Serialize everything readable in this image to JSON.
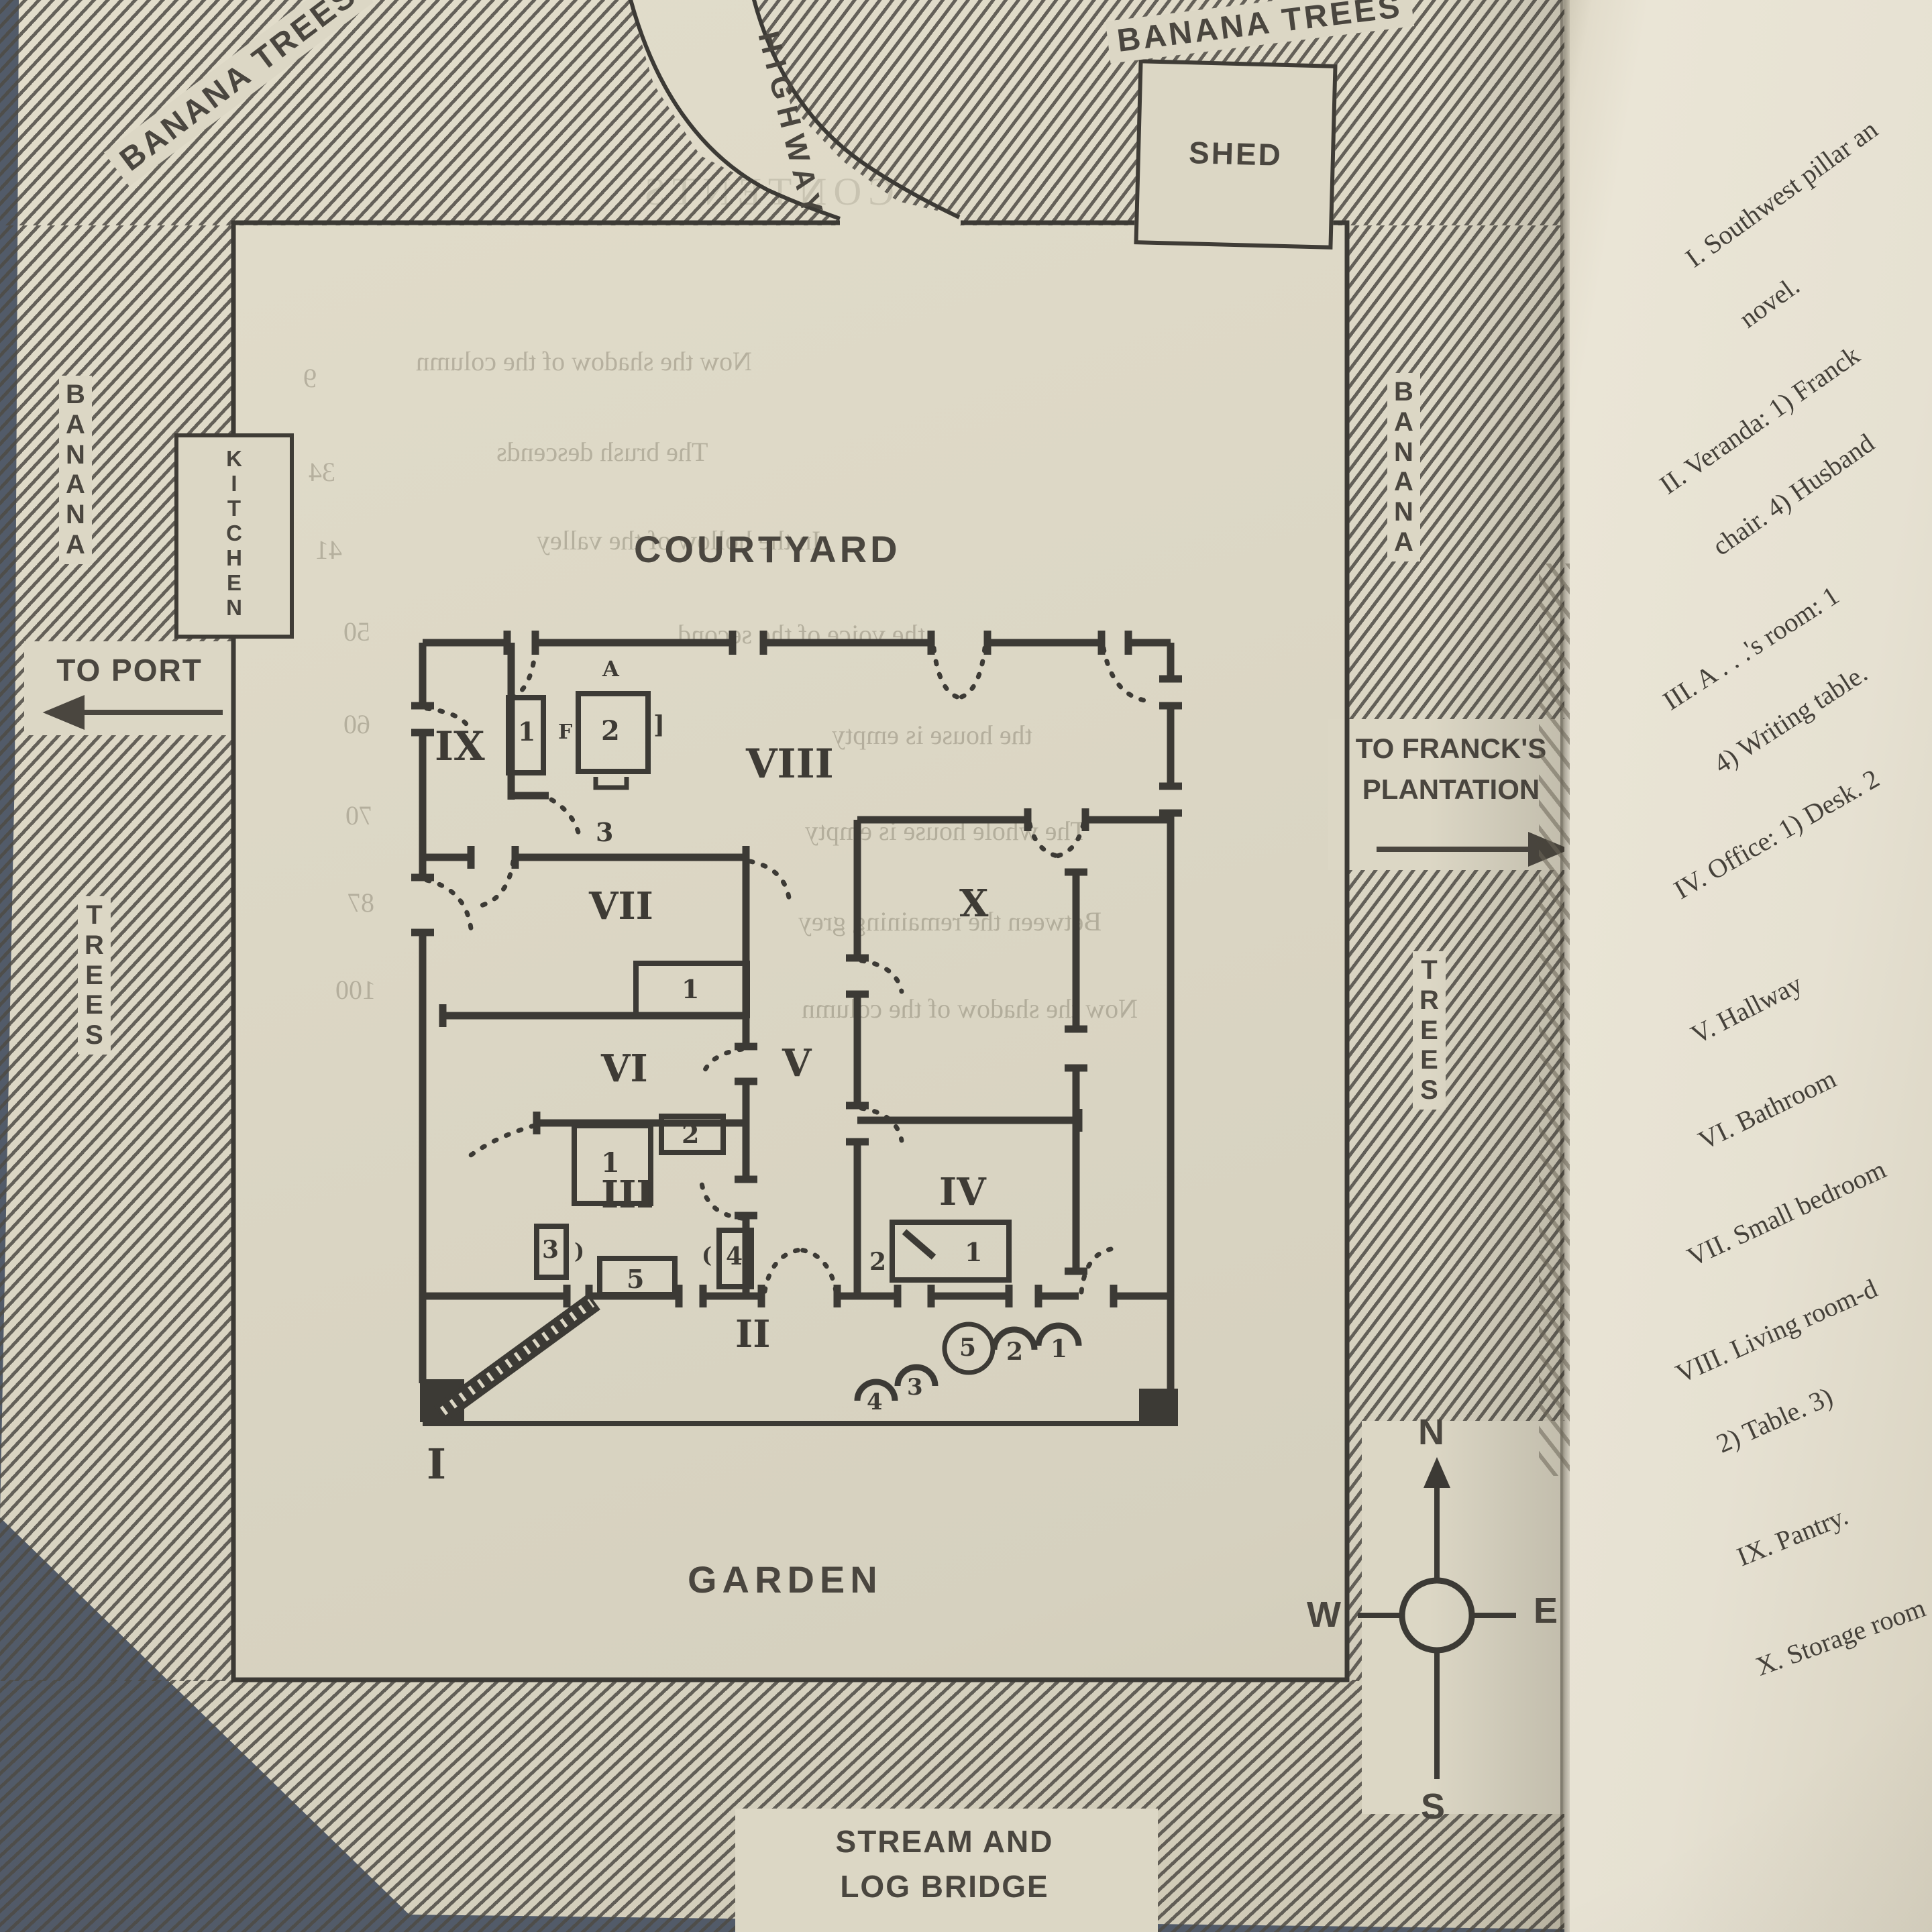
{
  "map": {
    "surroundings": {
      "banana_trees_top_left": "BANANA TREES",
      "highway": "HIGHWAY",
      "banana_trees_top_right": "BANANA TREES",
      "shed": "SHED",
      "banana_left": "B\nA\nN\nA\nN\nA",
      "kitchen": "K\nI\nT\nC\nH\nE\nN",
      "to_port": "TO PORT",
      "trees_left": "T\nR\nE\nE\nS",
      "banana_right": "B\nA\nN\nA\nN\nA",
      "to_francks": "TO FRANCK'S\nPLANTATION",
      "trees_right": "T\nR\nE\nE\nS",
      "courtyard": "COURTYARD",
      "garden": "GARDEN",
      "stream": "STREAM AND\nLOG BRIDGE"
    },
    "compass": {
      "north": "N",
      "south": "S",
      "east": "E",
      "west": "W"
    },
    "rooms": [
      {
        "numeral": "I"
      },
      {
        "numeral": "II"
      },
      {
        "numeral": "III"
      },
      {
        "numeral": "IV"
      },
      {
        "numeral": "V"
      },
      {
        "numeral": "VI"
      },
      {
        "numeral": "VII"
      },
      {
        "numeral": "VIII"
      },
      {
        "numeral": "IX"
      },
      {
        "numeral": "X"
      }
    ],
    "plan_marks": {
      "ix_item1": "1",
      "ix_f": "F",
      "ix_item2": "2",
      "ix_a": "A",
      "ix_bracket": "]",
      "ix_item3": "3",
      "vii_item1": "1",
      "vi_item1": "1",
      "vi_item2": "2",
      "iii_item3": "3",
      "iii_bracket_r": ")",
      "iii_item5": "5",
      "iii_bracket_l": "(",
      "iii_item4": "4",
      "iv_item1": "1",
      "iv_item2": "2",
      "veranda_item5": "5",
      "veranda_item2": "2",
      "veranda_item1": "1",
      "veranda_item3": "3",
      "veranda_item4": "4"
    },
    "bleed_through": {
      "title": "CONTENTS",
      "lines": [
        {
          "text": "Now the shadow of the column",
          "page": "9"
        },
        {
          "text": "The brush descends",
          "page": "34"
        },
        {
          "text": "In the hollow of the valley",
          "page": "41"
        },
        {
          "text": "the voice of the second",
          "page": "50"
        },
        {
          "text": "the house is empty",
          "page": "60"
        },
        {
          "text": "The whole house is empty",
          "page": "70"
        },
        {
          "text": "Between the remaining grey",
          "page": "87"
        },
        {
          "text": "Now the shadow of the column",
          "page": "100"
        }
      ]
    }
  },
  "legend_page": {
    "entries": [
      {
        "line1": "I. Southwest pillar an",
        "line2": "novel."
      },
      {
        "line1": "II. Veranda: 1) Franck",
        "line2": "chair. 4) Husband"
      },
      {
        "line1": "III. A . . .'s room: 1",
        "line2": "4) Writing table."
      },
      {
        "line1": "IV. Office: 1) Desk. 2",
        "line2": ""
      },
      {
        "line1": "V. Hallway",
        "line2": ""
      },
      {
        "line1": "VI. Bathroom",
        "line2": ""
      },
      {
        "line1": "VII. Small bedroom",
        "line2": ""
      },
      {
        "line1": "VIII. Living room-d",
        "line2": "2) Table. 3)"
      },
      {
        "line1": "IX. Pantry.",
        "line2": ""
      },
      {
        "line1": "X. Storage room",
        "line2": ""
      }
    ]
  },
  "colors": {
    "fabric": "#525b69",
    "page": "#dcd7c5",
    "page_right": "#e7e2d3",
    "ink": "#3c3a35"
  }
}
